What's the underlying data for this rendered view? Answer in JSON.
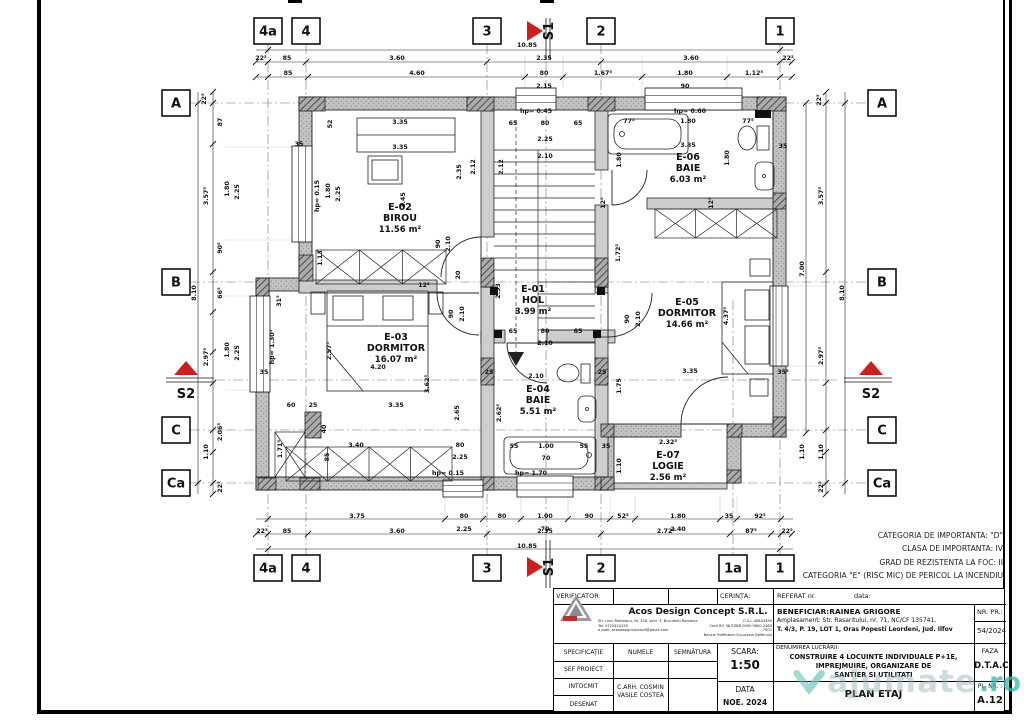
{
  "colors": {
    "accent_red": "#cc2020",
    "teal": "#3eb9ae",
    "wall_ext": "#bfbfbf",
    "wall_int": "#cdcdcd",
    "axis": "#777777"
  },
  "notes": [
    "CATEGORIA DE IMPORTANTA: \"D\"",
    "CLASA DE IMPORTANTA: IV",
    "GRAD DE REZISTENTA LA FOC: II",
    "CATEGORIA \"E\" (RISC MIC) DE PERICOL LA INCENDIU"
  ],
  "watermark": {
    "text": "ajumate",
    "tld": ".ro"
  },
  "grid": {
    "top_y": 31,
    "bottom_y": 568,
    "left_x": 176,
    "right_x": 882,
    "top": [
      [
        "4a",
        268
      ],
      [
        "4",
        306
      ],
      [
        "3",
        487
      ],
      [
        "2",
        601
      ],
      [
        "1",
        780
      ]
    ],
    "bottom": [
      [
        "4a",
        268
      ],
      [
        "4",
        306
      ],
      [
        "3",
        487
      ],
      [
        "2",
        601
      ],
      [
        "1a",
        733
      ],
      [
        "1",
        780
      ]
    ],
    "left": [
      [
        "A",
        103
      ],
      [
        "B",
        282
      ],
      [
        "C",
        430
      ],
      [
        "Ca",
        483
      ]
    ],
    "right": [
      [
        "A",
        103
      ],
      [
        "B",
        282
      ],
      [
        "C",
        430
      ],
      [
        "Ca",
        483
      ]
    ],
    "markers": [
      [
        "S1",
        553,
        31,
        "v"
      ],
      [
        "S1",
        553,
        567,
        "v"
      ],
      [
        "S2",
        186,
        398,
        "h"
      ],
      [
        "S2",
        871,
        398,
        "h"
      ]
    ]
  },
  "rooms": [
    {
      "id": "E-01",
      "name": "HOL",
      "area": "3.99 m²",
      "x": 533,
      "y": 292
    },
    {
      "id": "E-02",
      "name": "BIROU",
      "area": "11.56 m²",
      "x": 400,
      "y": 210
    },
    {
      "id": "E-03",
      "name": "DORMITOR",
      "area": "16.07 m²",
      "x": 396,
      "y": 340
    },
    {
      "id": "E-04",
      "name": "BAIE",
      "area": "5.51 m²",
      "x": 538,
      "y": 392
    },
    {
      "id": "E-05",
      "name": "DORMITOR",
      "area": "14.66 m²",
      "x": 687,
      "y": 305
    },
    {
      "id": "E-06",
      "name": "BAIE",
      "area": "6.03 m²",
      "x": 688,
      "y": 160
    },
    {
      "id": "E-07",
      "name": "LOGIE",
      "area": "2.56 m²",
      "x": 668,
      "y": 458
    }
  ],
  "dims": [
    [
      "10.85",
      527,
      47
    ],
    [
      "22⁵",
      261,
      60
    ],
    [
      "85",
      287,
      60
    ],
    [
      "3.60",
      397,
      60
    ],
    [
      "2.35",
      544,
      60
    ],
    [
      "3.60",
      691,
      60
    ],
    [
      "22⁵",
      788,
      60
    ],
    [
      "85",
      288,
      75
    ],
    [
      "4.60",
      417,
      75
    ],
    [
      "80",
      544,
      75
    ],
    [
      "1.67⁵",
      603,
      75
    ],
    [
      "1.80",
      685,
      75
    ],
    [
      "1.12⁵",
      754,
      75
    ],
    [
      "2.15",
      544,
      88
    ],
    [
      "90",
      685,
      88
    ],
    [
      "3.75",
      357,
      518
    ],
    [
      "80",
      464,
      518
    ],
    [
      "80",
      502,
      518
    ],
    [
      "1.00",
      545,
      518
    ],
    [
      "90",
      589,
      518
    ],
    [
      "52⁵",
      623,
      518
    ],
    [
      "1.80",
      678,
      518
    ],
    [
      "35",
      729,
      518
    ],
    [
      "92⁵",
      760,
      518
    ],
    [
      "2.25",
      464,
      531
    ],
    [
      "70",
      545,
      531
    ],
    [
      "2.40",
      678,
      531
    ],
    [
      "22⁵",
      262,
      533
    ],
    [
      "85",
      287,
      533
    ],
    [
      "3.60",
      397,
      533
    ],
    [
      "2.35",
      545,
      533
    ],
    [
      "2.72⁵",
      666,
      533
    ],
    [
      "87⁵",
      751,
      533
    ],
    [
      "22⁵",
      787,
      533
    ],
    [
      "10.85",
      527,
      548
    ],
    [
      "22⁵",
      206,
      99,
      1
    ],
    [
      "87",
      222,
      122,
      1
    ],
    [
      "3.57⁵",
      208,
      196,
      1
    ],
    [
      "1.80",
      229,
      189,
      1
    ],
    [
      "2.25",
      239,
      192,
      1
    ],
    [
      "90⁵",
      222,
      248,
      1
    ],
    [
      "8.10",
      196,
      293,
      1
    ],
    [
      "66⁵",
      222,
      293,
      1
    ],
    [
      "2.97⁵",
      208,
      357,
      1
    ],
    [
      "1.80",
      229,
      350,
      1
    ],
    [
      "2.25",
      239,
      353,
      1
    ],
    [
      "2.06⁵",
      222,
      432,
      1
    ],
    [
      "1.10",
      208,
      452,
      1
    ],
    [
      "22⁵",
      222,
      487,
      1
    ],
    [
      "22⁵",
      821,
      100,
      1
    ],
    [
      "3.57⁵",
      823,
      196,
      1
    ],
    [
      "7.00",
      804,
      269,
      1
    ],
    [
      "8.10",
      844,
      293,
      1
    ],
    [
      "2.97⁵",
      823,
      356,
      1
    ],
    [
      "1.10",
      804,
      452,
      1
    ],
    [
      "1.10",
      823,
      452,
      1
    ],
    [
      "22⁵",
      823,
      487,
      1
    ],
    [
      "hp= 0.45",
      536,
      113
    ],
    [
      "65",
      513,
      125
    ],
    [
      "80",
      545,
      125
    ],
    [
      "65",
      578,
      125
    ],
    [
      "2.25",
      545,
      141
    ],
    [
      "2.10",
      545,
      158
    ],
    [
      "3.35",
      400,
      124
    ],
    [
      "3.35",
      400,
      149
    ],
    [
      "52",
      332,
      124,
      1
    ],
    [
      "2.12",
      475,
      167,
      1
    ],
    [
      "2.12",
      503,
      167,
      1
    ],
    [
      "2.35",
      461,
      172,
      1
    ],
    [
      "3.45",
      405,
      200,
      1
    ],
    [
      "hp= 0.15",
      319,
      196,
      1
    ],
    [
      "1.80",
      330,
      191,
      1
    ],
    [
      "2.25",
      340,
      194,
      1
    ],
    [
      "35",
      299,
      146
    ],
    [
      "1.13",
      322,
      258,
      1
    ],
    [
      "90",
      440,
      244,
      1
    ],
    [
      "2.10",
      450,
      244,
      1
    ],
    [
      "20",
      460,
      275,
      1
    ],
    [
      "2.53",
      500,
      291,
      1
    ],
    [
      "12⁵",
      424,
      287
    ],
    [
      "hp= 0.60",
      690,
      113
    ],
    [
      "77⁵",
      629,
      123
    ],
    [
      "1.80",
      688,
      123
    ],
    [
      "77⁵",
      748,
      123
    ],
    [
      "3.35",
      688,
      147
    ],
    [
      "1.80",
      621,
      160,
      1
    ],
    [
      "1.80",
      729,
      158,
      1
    ],
    [
      "35",
      783,
      148
    ],
    [
      "12⁵",
      605,
      203,
      1
    ],
    [
      "12⁵",
      713,
      203,
      1
    ],
    [
      "1.72⁵",
      620,
      253,
      1
    ],
    [
      "4.37⁵",
      728,
      316,
      1
    ],
    [
      "3.35",
      690,
      373
    ],
    [
      "35⁵",
      783,
      374
    ],
    [
      "1.75",
      621,
      386,
      1
    ],
    [
      "90",
      629,
      319,
      1
    ],
    [
      "2.10",
      640,
      319,
      1
    ],
    [
      "31⁵",
      281,
      301,
      1
    ],
    [
      "hp= 1.30⁵",
      274,
      347,
      1
    ],
    [
      "35",
      264,
      374
    ],
    [
      "2.57⁵",
      331,
      351,
      1
    ],
    [
      "4.20",
      378,
      369
    ],
    [
      "3.62⁵",
      429,
      384,
      1
    ],
    [
      "90",
      453,
      314,
      1
    ],
    [
      "2.10",
      464,
      314,
      1
    ],
    [
      "60",
      291,
      407
    ],
    [
      "25",
      313,
      407
    ],
    [
      "40",
      326,
      429,
      1
    ],
    [
      "3.35",
      396,
      407
    ],
    [
      "2.65",
      459,
      413,
      1
    ],
    [
      "3.40",
      356,
      447
    ],
    [
      "85",
      329,
      457,
      1
    ],
    [
      "80",
      460,
      447
    ],
    [
      "2.25",
      460,
      459
    ],
    [
      "1.71⁵",
      282,
      449,
      1
    ],
    [
      "65",
      513,
      333
    ],
    [
      "80",
      545,
      333
    ],
    [
      "65",
      578,
      333
    ],
    [
      "2.10",
      545,
      345
    ],
    [
      "2.10",
      536,
      378
    ],
    [
      "25",
      489,
      374
    ],
    [
      "25",
      602,
      374
    ],
    [
      "2.62⁵",
      501,
      413,
      1
    ],
    [
      "55",
      514,
      448
    ],
    [
      "1.00",
      546,
      448
    ],
    [
      "70",
      546,
      460
    ],
    [
      "55",
      584,
      448
    ],
    [
      "35",
      606,
      448
    ],
    [
      "hp= 0.15",
      448,
      475
    ],
    [
      "hp= 1.70",
      531,
      475
    ],
    [
      "2.32⁵",
      668,
      444
    ],
    [
      "1.10",
      621,
      466,
      1
    ]
  ],
  "geometry": {
    "walls_ext": [
      [
        299,
        97,
        487,
        13
      ],
      [
        299,
        110,
        13,
        177
      ],
      [
        256,
        278,
        13,
        212
      ],
      [
        269,
        278,
        43,
        13
      ],
      [
        256,
        477,
        358,
        13
      ],
      [
        773,
        110,
        13,
        327
      ],
      [
        601,
        424,
        80,
        13
      ],
      [
        728,
        424,
        58,
        13
      ],
      [
        601,
        437,
        13,
        53
      ],
      [
        727,
        437,
        14,
        46
      ]
    ],
    "walls_int": [
      [
        481,
        110,
        13,
        127
      ],
      [
        481,
        277,
        13,
        10
      ],
      [
        595,
        110,
        13,
        60
      ],
      [
        595,
        205,
        13,
        82
      ],
      [
        299,
        280,
        138,
        13
      ],
      [
        647,
        198,
        130,
        11
      ],
      [
        481,
        330,
        24,
        13
      ],
      [
        547,
        330,
        68,
        13
      ],
      [
        481,
        287,
        13,
        190
      ],
      [
        595,
        337,
        13,
        140
      ],
      [
        595,
        287,
        13,
        6
      ],
      [
        614,
        483,
        113,
        6
      ]
    ],
    "piers": [
      [
        299,
        97,
        26,
        14
      ],
      [
        467,
        97,
        27,
        14
      ],
      [
        588,
        97,
        27,
        14
      ],
      [
        757,
        97,
        29,
        14
      ],
      [
        299,
        255,
        14,
        26
      ],
      [
        256,
        278,
        13,
        26
      ],
      [
        256,
        370,
        13,
        22
      ],
      [
        481,
        258,
        13,
        29
      ],
      [
        595,
        258,
        13,
        29
      ],
      [
        481,
        358,
        13,
        27
      ],
      [
        595,
        358,
        13,
        27
      ],
      [
        258,
        478,
        18,
        12
      ],
      [
        300,
        478,
        20,
        12
      ],
      [
        481,
        477,
        13,
        13
      ],
      [
        595,
        477,
        13,
        13
      ],
      [
        773,
        193,
        13,
        16
      ],
      [
        773,
        287,
        13,
        26
      ],
      [
        773,
        417,
        13,
        20
      ],
      [
        601,
        424,
        13,
        13
      ],
      [
        727,
        424,
        15,
        13
      ],
      [
        601,
        477,
        13,
        13
      ],
      [
        727,
        470,
        14,
        13
      ]
    ],
    "windows": [
      [
        516,
        88,
        40,
        22,
        "h"
      ],
      [
        645,
        88,
        97,
        22,
        "h"
      ],
      [
        292,
        146,
        20,
        96,
        "v"
      ],
      [
        250,
        296,
        20,
        96,
        "v"
      ],
      [
        770,
        286,
        18,
        80,
        "v"
      ],
      [
        443,
        480,
        40,
        17,
        "h"
      ],
      [
        517,
        476,
        56,
        21,
        "h"
      ]
    ],
    "dimlines_h": [
      {
        "y": 50,
        "x1": 256,
        "x2": 793,
        "ticks": [
          268,
          780
        ]
      },
      {
        "y": 62,
        "x1": 256,
        "x2": 793,
        "ticks": [
          256,
          268,
          306,
          487,
          601,
          780,
          792
        ]
      },
      {
        "y": 77,
        "x1": 256,
        "x2": 793,
        "ticks": [
          256,
          268,
          308,
          525,
          563,
          642,
          727,
          780,
          792
        ]
      },
      {
        "y": 519,
        "x1": 256,
        "x2": 793,
        "ticks": [
          268,
          445,
          483,
          521,
          568,
          610,
          635,
          720,
          737,
          781
        ]
      },
      {
        "y": 534,
        "x1": 256,
        "x2": 793,
        "ticks": [
          256,
          268,
          308,
          487,
          601,
          730,
          771,
          781,
          792
        ]
      },
      {
        "y": 549,
        "x1": 256,
        "x2": 793,
        "ticks": [
          268,
          780
        ]
      }
    ],
    "dimlines_v": [
      {
        "x": 198,
        "y1": 92,
        "y2": 494,
        "ticks": [
          103,
          483
        ]
      },
      {
        "x": 213,
        "y1": 92,
        "y2": 494,
        "ticks": [
          92,
          103,
          144,
          272,
          312,
          352,
          383,
          430,
          452,
          483,
          494
        ]
      },
      {
        "x": 806,
        "y1": 103,
        "y2": 433,
        "ticks": [
          103,
          433
        ]
      },
      {
        "x": 826,
        "y1": 92,
        "y2": 494,
        "ticks": [
          92,
          103,
          272,
          383,
          430,
          452,
          483,
          494
        ]
      },
      {
        "x": 845,
        "y1": 92,
        "y2": 494,
        "ticks": [
          103,
          483
        ]
      }
    ],
    "axes_v": [
      [
        268,
        44,
        556
      ],
      [
        306,
        44,
        556
      ],
      [
        487,
        44,
        556
      ],
      [
        601,
        44,
        556
      ],
      [
        780,
        44,
        556
      ],
      [
        733,
        300,
        556
      ],
      [
        546,
        62,
        540
      ]
    ],
    "axes_h": [
      [
        103,
        190,
        868
      ],
      [
        282,
        190,
        868
      ],
      [
        430,
        190,
        868
      ],
      [
        483,
        190,
        868
      ],
      [
        380,
        215,
        838
      ]
    ],
    "lightlines": [
      [
        445,
        496,
        445,
        519
      ],
      [
        483,
        496,
        483,
        519
      ],
      [
        521,
        496,
        521,
        519
      ],
      [
        568,
        496,
        568,
        519
      ],
      [
        610,
        496,
        610,
        519
      ],
      [
        635,
        496,
        635,
        519
      ],
      [
        720,
        496,
        720,
        519
      ],
      [
        737,
        496,
        737,
        519
      ],
      [
        525,
        56,
        525,
        88
      ],
      [
        563,
        56,
        563,
        88
      ],
      [
        642,
        56,
        642,
        97
      ],
      [
        727,
        56,
        727,
        97
      ],
      [
        225,
        147,
        292,
        147
      ],
      [
        225,
        240,
        292,
        240
      ],
      [
        225,
        296,
        256,
        296
      ],
      [
        225,
        390,
        256,
        390
      ],
      [
        790,
        286,
        826,
        286
      ],
      [
        790,
        366,
        826,
        366
      ]
    ]
  },
  "titleblock": {
    "verificator": "VERIFICATOR",
    "cerinta": "CERINȚA:",
    "referat": "REFERAT nr.",
    "data_word": "data:",
    "company": "Acos Design Concept S.R.L.",
    "addr1": "Str. Liviu Rebreanu, Nr. 328, sect. 3, Bucuresti-Romania",
    "addr2": "Tel. 0725424155",
    "addr3": "e-mail: acosdesignconcept@gmail.com",
    "fisc1": "C.U.I. 40843490",
    "fisc2": "Cont RO 36 RZBR 0000 0600 2483 7901",
    "fisc3": "Banca: Raiffeisen-Sucursala Delfinului",
    "beneficiar": "BENEFICIAR:RAINEA GRIGORE",
    "amplasament1": "Amplasament: Str. Rasaritului, nr. 71, NC/CF 135741,",
    "amplasament2": "T. 4/3, P. 19, LOT 1, Oras Popesti Leordeni, Jud. Ilfov",
    "nr_pr_label": "NR. PR.:",
    "nr_pr": "54/2024",
    "specificatie": "SPECIFICAȚIE",
    "numele": "NUMELE",
    "semnatura": "SEMNĂTURA",
    "scara_label": "SCARA:",
    "scara": "1:50",
    "denumire_label": "DENUMIREA LUCRĂRII:",
    "denumire1": "CONSTRUIRE 4 LOCUINTE INDIVIDUALE P+1E,",
    "denumire2": "IMPREJMUIRE, ORGANIZARE DE",
    "denumire3": "SANTIER SI UTILITATI",
    "faza_label": "FAZA",
    "faza": "D.T.A.C.",
    "sef": "ȘEF PROIECT",
    "intocmit": "INTOCMIT",
    "desenat": "DESENAT",
    "name1": "C.ARH. COSMIN",
    "name2": "VASILE COSTEA",
    "data_label": "DATA",
    "data": "NOE. 2024",
    "plansa": "PLAN ETAJ",
    "pl_nr_label": "PL. NR. :",
    "pl_nr": "A.12"
  }
}
